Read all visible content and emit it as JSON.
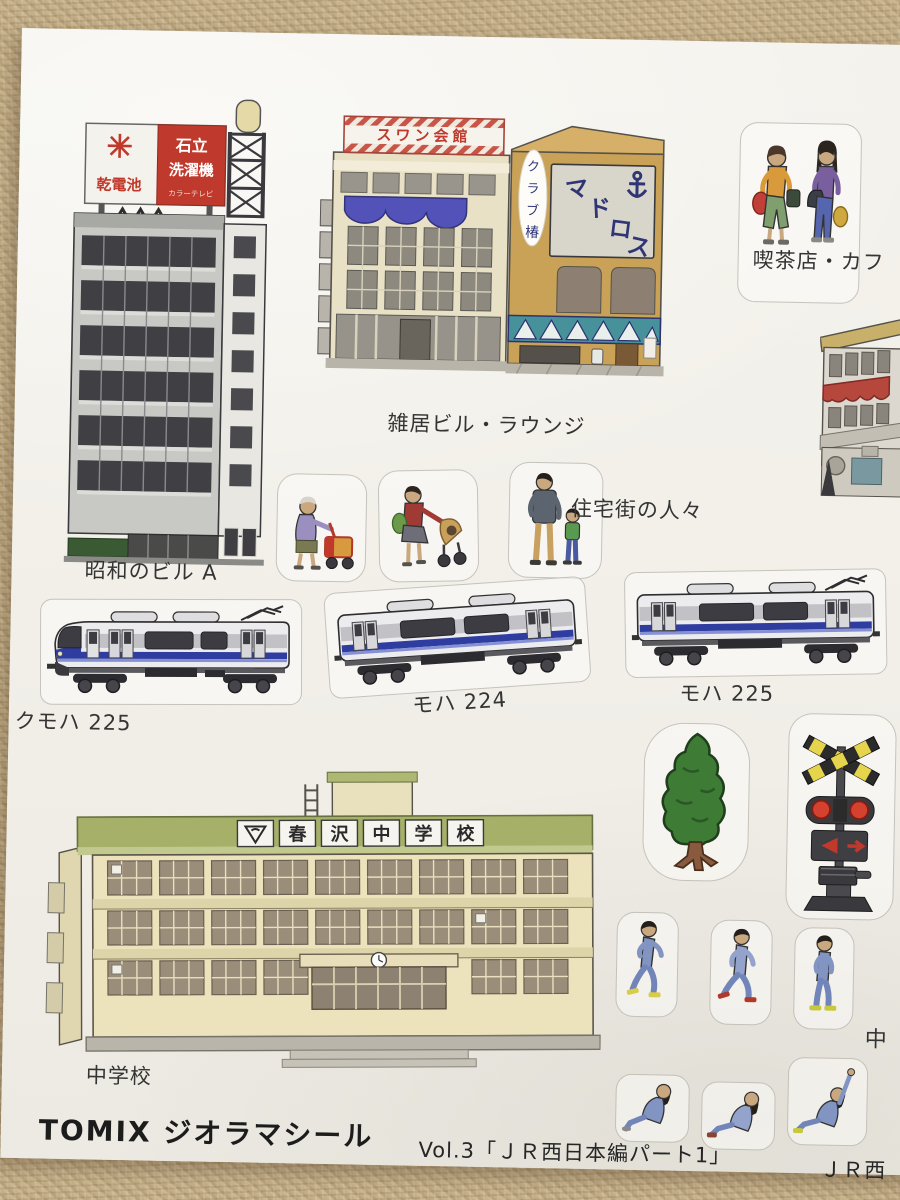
{
  "footer": {
    "brand_title": "TOMIX ジオラマシール",
    "volume_title": "Vol.3「ＪＲ西日本編パート1」",
    "volume_next_cutoff": "ＪＲ西"
  },
  "labels": {
    "cafe_people": "喫茶店・カフ",
    "multi_tenant_building": "雑居ビル・ラウンジ",
    "showa_building_a": "昭和のビル A",
    "residential_people": "住宅街の人々",
    "kumoha_225": "クモハ 225",
    "moha_224": "モハ 224",
    "moha_225": "モハ 225",
    "junior_high_school": "中学校",
    "right_edge_cutoff": "中"
  },
  "signs": {
    "swan_hall": "スワン会館",
    "madoros_chars": [
      "マ",
      "ド",
      "ロ",
      "ス"
    ],
    "club_vertical_chars": [
      "ク",
      "ラ",
      "ブ",
      "椿"
    ],
    "rooftop_battery": "乾電池",
    "rooftop_maker_line1": "石立",
    "rooftop_maker_line2": "洗濯機",
    "rooftop_maker_small": "カラーテレビ",
    "school_name_panels": [
      "春",
      "沢",
      "中",
      "学",
      "校"
    ]
  },
  "colors": {
    "sheet_white": "#f2f0ea",
    "fabric_beige": "#c3ae88",
    "sign_red": "#bf3a2c",
    "awning_blue": "#5252b8",
    "lounge_tan": "#c9a258",
    "band_teal": "#47919b",
    "train_stripe_blue": "#2f3da0",
    "school_roof_green": "#a6b068",
    "school_wall_cream": "#ece3bd",
    "tree_green": "#3e7c36"
  }
}
